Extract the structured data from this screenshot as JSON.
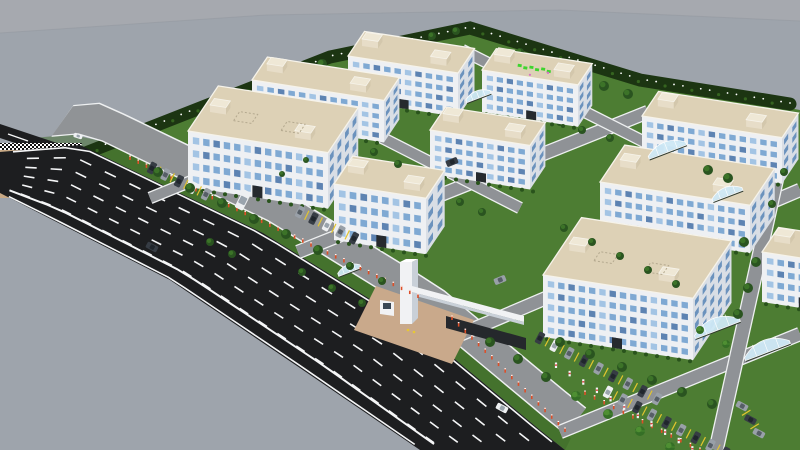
{
  "meta": {
    "view": "aerial-3d-render",
    "subject": "industrial-park-campus"
  },
  "scene": {
    "canvas": {
      "w": 800,
      "h": 450
    },
    "colors": {
      "sky": "#a6a9af",
      "ground": "#9ea4ac",
      "horizon": "#8e939b",
      "lawn": "#4d7d33",
      "lawnDark": "#3c6827",
      "road": "#1d1e20",
      "roadLine": "#f5f6f7",
      "innerRoad": "#8f9296",
      "innerEdge": "#eef0f1",
      "apron": "#909396",
      "wallFront": "#eef0f3",
      "wallSide": "#d9dee5",
      "win": "#7fa9d3",
      "winDark": "#5d83b2",
      "winLight": "#a3c4e4",
      "winSide": "#6b92bd",
      "roof": "#ddd1b6",
      "roofEdge": "#f6f3ea",
      "towerFront": "#e7ddc8",
      "towerSide": "#d3c7ac",
      "towerTop": "#efe8d6",
      "tree": "#2a5420",
      "treeHi": "#3c7328",
      "palm": "#356f26",
      "palmHi": "#4f8f33",
      "hedge": "#29531c",
      "bandGreen": "#1c3512",
      "speck": "#35641f",
      "dotWhite": "#ffffff",
      "bollard": "#dd4f28",
      "post": "#f4f6f7",
      "postRed": "#d84040",
      "tan": "#c8a985",
      "plaza": "#c9a98b",
      "gateWhite": "#f1f2f4",
      "gateShade": "#c9d0d8",
      "gateSign": "#25282c",
      "gateLight": "#e8c832",
      "canopy": "#cfe9f6",
      "canopyRib": "#ffffff",
      "carDark": "#363c44",
      "carGray": "#99a0a8",
      "carWhite": "#eef0f2",
      "glassDark": "#20262c",
      "glassGray": "#565e66",
      "glassWhite": "#9aa4ad",
      "divider": "#e3c52f",
      "signGreen": "#3ed42e",
      "signPink": "#d86fc8",
      "door": "#262a2e"
    },
    "skyline": [
      [
        0,
        33
      ],
      [
        266,
        15
      ],
      [
        560,
        10
      ],
      [
        800,
        21
      ]
    ],
    "campus": [
      [
        55,
        168
      ],
      [
        330,
        57
      ],
      [
        470,
        28
      ],
      [
        640,
        80
      ],
      [
        800,
        110
      ],
      [
        800,
        450
      ],
      [
        565,
        450
      ],
      [
        540,
        430
      ],
      [
        420,
        330
      ],
      [
        263,
        233
      ],
      [
        80,
        145
      ]
    ],
    "mainRoad": {
      "upper": [
        [
          0,
          152
        ],
        [
          80,
          145
        ],
        [
          263,
          233
        ],
        [
          420,
          330
        ],
        [
          540,
          430
        ],
        [
          565,
          450
        ]
      ],
      "lower": [
        [
          0,
          193
        ],
        [
          170,
          280
        ],
        [
          300,
          368
        ],
        [
          420,
          450
        ]
      ],
      "lanes": 6,
      "dashLen": 13
    },
    "sideRoad": [
      [
        0,
        124
      ],
      [
        60,
        144
      ],
      [
        60,
        158
      ],
      [
        0,
        138
      ]
    ],
    "tanPatch": [
      [
        0,
        148
      ],
      [
        80,
        148
      ],
      [
        62,
        198
      ],
      [
        0,
        198
      ]
    ],
    "checkerTop": [
      [
        0,
        143
      ],
      [
        82,
        143
      ],
      [
        80,
        150
      ],
      [
        0,
        150
      ]
    ],
    "checkerRight": [
      [
        78,
        146
      ],
      [
        86,
        149
      ],
      [
        68,
        200
      ],
      [
        60,
        197
      ]
    ],
    "treeBand": {
      "path": [
        [
          55,
          165
        ],
        [
          330,
          57
        ],
        [
          470,
          28
        ],
        [
          640,
          80
        ],
        [
          790,
          104
        ]
      ],
      "width": 13,
      "dotGap": 9
    },
    "apron": {
      "t0": 0.07,
      "t1": 1.0,
      "o1": 14,
      "o2": 46
    },
    "stripShade": {
      "t0": 0.05,
      "t1": 1.0,
      "o1": 0,
      "o2": 13
    },
    "innerRoads": [
      {
        "a": [
          150,
          198
        ],
        "b": [
          400,
          96
        ],
        "w": 10
      },
      {
        "a": [
          298,
          252
        ],
        "b": [
          648,
          112
        ],
        "w": 12
      },
      {
        "a": [
          452,
          338
        ],
        "b": [
          800,
          190
        ],
        "w": 12
      },
      {
        "a": [
          560,
          432
        ],
        "b": [
          800,
          334
        ],
        "w": 12
      },
      {
        "a": [
          300,
          96
        ],
        "b": [
          520,
          208
        ],
        "w": 10
      },
      {
        "a": [
          462,
          50
        ],
        "b": [
          700,
          170
        ],
        "w": 10
      },
      {
        "a": [
          790,
          118
        ],
        "b": [
          716,
          450
        ],
        "w": 13
      }
    ],
    "buildings": [
      {
        "id": "top-a",
        "x": 348,
        "y": 100,
        "fw": 110,
        "sd": 30,
        "wh": 44,
        "floors": 4
      },
      {
        "id": "top-green-sign",
        "x": 482,
        "y": 112,
        "fw": 96,
        "sd": 26,
        "wh": 42,
        "floors": 4,
        "roof_sign": true
      },
      {
        "id": "left-rear",
        "x": 252,
        "y": 122,
        "fw": 132,
        "sd": 28,
        "wh": 42,
        "floors": 4
      },
      {
        "id": "canteen-low",
        "x": 256,
        "y": 150,
        "fw": 72,
        "sd": 16,
        "wh": 13,
        "floors": 1
      },
      {
        "id": "right-far",
        "x": 642,
        "y": 162,
        "fw": 140,
        "sd": 30,
        "wh": 46,
        "floors": 4
      },
      {
        "id": "center-right",
        "x": 430,
        "y": 174,
        "fw": 100,
        "sd": 28,
        "wh": 44,
        "floors": 4
      },
      {
        "id": "left-front",
        "x": 188,
        "y": 187,
        "fw": 140,
        "sd": 55,
        "wh": 56,
        "floors": 4,
        "roof_hatch": true
      },
      {
        "id": "right-mid",
        "x": 600,
        "y": 230,
        "fw": 150,
        "sd": 45,
        "wh": 48,
        "floors": 4
      },
      {
        "id": "center",
        "x": 334,
        "y": 240,
        "fw": 92,
        "sd": 34,
        "wh": 56,
        "floors": 4
      },
      {
        "id": "far-right-partial",
        "x": 762,
        "y": 302,
        "fw": 80,
        "sd": 30,
        "wh": 50,
        "floors": 4
      },
      {
        "id": "bottom-right",
        "x": 543,
        "y": 337,
        "fw": 150,
        "sd": 70,
        "wh": 62,
        "floors": 5,
        "roof_hatch": true
      }
    ],
    "gate": {
      "plaza": [
        [
          376,
          286
        ],
        [
          474,
          320
        ],
        [
          452,
          364
        ],
        [
          354,
          330
        ]
      ],
      "pylon": {
        "x": 400,
        "y": 262,
        "w": 12,
        "h": 62
      },
      "beam": [
        [
          412,
          286
        ],
        [
          524,
          316
        ],
        [
          524,
          322
        ],
        [
          412,
          292
        ]
      ],
      "beamShade": [
        [
          412,
          292
        ],
        [
          524,
          322
        ],
        [
          524,
          325
        ],
        [
          412,
          295
        ]
      ],
      "sign": [
        [
          446,
          316
        ],
        [
          526,
          338
        ],
        [
          526,
          350
        ],
        [
          446,
          328
        ]
      ],
      "booth": {
        "x": 380,
        "y": 300,
        "w": 14,
        "h": 16
      },
      "lights": [
        [
          408,
          330
        ],
        [
          414,
          332
        ]
      ]
    },
    "canopies": [
      {
        "x": 338,
        "y": 272,
        "w": 24,
        "h": 12
      },
      {
        "x": 466,
        "y": 98,
        "w": 26,
        "h": 12
      },
      {
        "x": 648,
        "y": 152,
        "w": 40,
        "h": 18
      },
      {
        "x": 712,
        "y": 196,
        "w": 32,
        "h": 15
      },
      {
        "x": 694,
        "y": 330,
        "w": 48,
        "h": 22
      },
      {
        "x": 744,
        "y": 352,
        "w": 48,
        "h": 22
      }
    ],
    "bollardLines": [
      {
        "from": [
          130,
          160
        ],
        "to": [
          418,
          298
        ],
        "gap": 9
      },
      {
        "from": [
          452,
          320
        ],
        "to": [
          565,
          432
        ],
        "gap": 9
      },
      {
        "from": [
          585,
          395
        ],
        "to": [
          700,
          452
        ],
        "gap": 10
      }
    ],
    "whitePosts": {
      "from": [
        556,
        368
      ],
      "to": [
        706,
        460
      ],
      "gap": 15
    },
    "carRows": [
      {
        "start": [
          152,
          168
        ],
        "dir": [
          1,
          0.485
        ],
        "n": 5,
        "gap": 15,
        "ang": 117
      },
      {
        "start": [
          300,
          212
        ],
        "dir": [
          1,
          0.485
        ],
        "n": 5,
        "gap": 15,
        "ang": 117
      },
      {
        "start": [
          540,
          338
        ],
        "dir": [
          1,
          0.52
        ],
        "n": 9,
        "gap": 16.5,
        "ang": 118
      },
      {
        "start": [
          608,
          392
        ],
        "dir": [
          1,
          0.52
        ],
        "n": 9,
        "gap": 16.5,
        "ang": 118
      },
      {
        "start": [
          742,
          406
        ],
        "dir": [
          0.62,
          1
        ],
        "n": 3,
        "gap": 16,
        "ang": 28
      }
    ],
    "roadCars": [
      {
        "x": 502,
        "y": 408,
        "type": "white",
        "ang": 28
      },
      {
        "x": 152,
        "y": 247,
        "type": "dark",
        "ang": 28
      },
      {
        "x": 452,
        "y": 162,
        "type": "dark",
        "ang": -22
      },
      {
        "x": 500,
        "y": 280,
        "type": "gray",
        "ang": -22
      },
      {
        "x": 78,
        "y": 136,
        "type": "white",
        "ang": 18,
        "small": true
      },
      {
        "x": 243,
        "y": 200,
        "type": "white",
        "ang": 117,
        "van": true
      }
    ],
    "treesFar": [
      [
        300,
        72,
        5
      ],
      [
        322,
        64,
        5
      ],
      [
        432,
        36,
        4
      ],
      [
        456,
        31,
        4
      ],
      [
        520,
        52,
        4
      ],
      [
        556,
        64,
        4
      ],
      [
        604,
        86,
        5
      ],
      [
        628,
        94,
        5
      ],
      [
        660,
        98,
        4
      ],
      [
        700,
        104,
        4
      ],
      [
        736,
        110,
        4
      ],
      [
        768,
        116,
        4
      ],
      [
        480,
        136,
        4
      ],
      [
        502,
        142,
        4
      ],
      [
        560,
        122,
        4
      ],
      [
        582,
        130,
        4
      ],
      [
        610,
        138,
        4
      ],
      [
        690,
        136,
        4
      ],
      [
        248,
        108,
        4
      ],
      [
        226,
        122,
        4
      ]
    ],
    "treesNear": [
      [
        158,
        172,
        5
      ],
      [
        190,
        188,
        5
      ],
      [
        222,
        203,
        5
      ],
      [
        254,
        219,
        5
      ],
      [
        286,
        234,
        5
      ],
      [
        318,
        250,
        5
      ],
      [
        350,
        266,
        4
      ],
      [
        382,
        281,
        4
      ],
      [
        490,
        342,
        5
      ],
      [
        518,
        359,
        5
      ],
      [
        546,
        377,
        5
      ],
      [
        210,
        242,
        4
      ],
      [
        232,
        254,
        4
      ],
      [
        302,
        272,
        4
      ],
      [
        332,
        288,
        4
      ],
      [
        362,
        303,
        4
      ],
      [
        460,
        202,
        4
      ],
      [
        482,
        212,
        4
      ],
      [
        564,
        228,
        4
      ],
      [
        592,
        242,
        4
      ],
      [
        620,
        256,
        4
      ],
      [
        648,
        270,
        4
      ],
      [
        676,
        284,
        4
      ],
      [
        560,
        342,
        5
      ],
      [
        590,
        354,
        5
      ],
      [
        622,
        367,
        5
      ],
      [
        652,
        380,
        5
      ],
      [
        682,
        392,
        5
      ],
      [
        712,
        404,
        5
      ],
      [
        744,
        242,
        5
      ],
      [
        756,
        262,
        5
      ],
      [
        748,
        288,
        5
      ],
      [
        738,
        314,
        5
      ],
      [
        772,
        204,
        4
      ],
      [
        784,
        172,
        4
      ],
      [
        708,
        170,
        5
      ],
      [
        728,
        178,
        5
      ],
      [
        374,
        152,
        4
      ],
      [
        398,
        164,
        4
      ],
      [
        306,
        160,
        3
      ],
      [
        282,
        174,
        3
      ]
    ],
    "palms": [
      [
        576,
        396,
        5
      ],
      [
        608,
        414,
        5
      ],
      [
        640,
        431,
        5
      ],
      [
        670,
        447,
        5
      ],
      [
        700,
        330,
        4
      ],
      [
        726,
        344,
        4
      ]
    ]
  }
}
